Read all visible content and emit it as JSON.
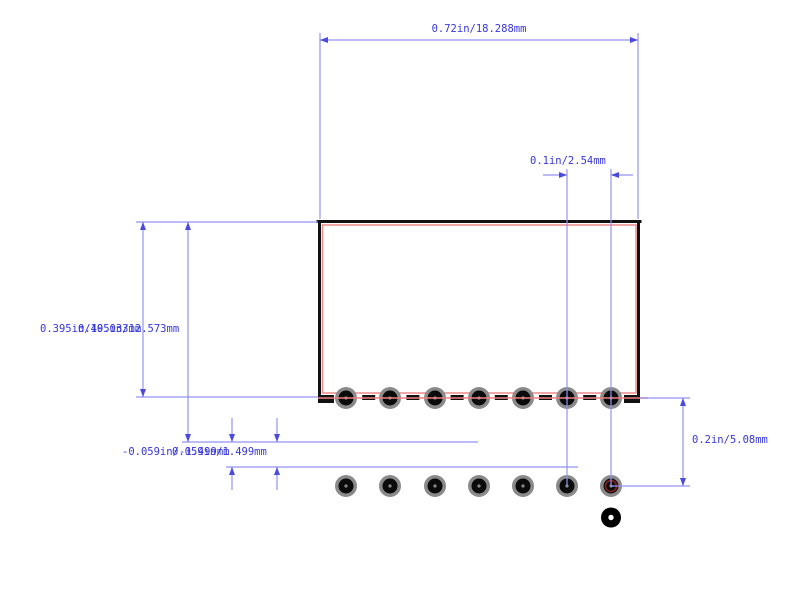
{
  "drawing": {
    "width": 800,
    "height": 590,
    "colors": {
      "background": "#ffffff",
      "dim_line": "#9292f2",
      "dim_arrow": "#4a4ade",
      "dim_text": "#3636df",
      "body_outline": "#111111",
      "silkscreen": "#ee8a8a",
      "centerline": "#f08080",
      "pad_outer": "#8a8a8a",
      "pad_inner": "#0b0b0b",
      "pad_center_dot": "#8a8a8a",
      "pin_marker_ring": "#7a2020",
      "hole_fill": "#000000",
      "hole_center": "#ffffff"
    },
    "body": {
      "x1": 318,
      "y1": 220,
      "x2": 640,
      "y2": 398,
      "edge_width": 3,
      "dashed_bottom": {
        "y": 397.5,
        "thickness": 5,
        "dash": 13,
        "gap": 31.2
      },
      "corner_feet": [
        [
          318,
          395,
          16,
          8
        ],
        [
          624,
          395,
          16,
          8
        ]
      ]
    },
    "silkscreen_rect": {
      "x1": 322.5,
      "y1": 225,
      "x2": 636,
      "y2": 393,
      "stroke_width": 1.5
    },
    "centerline": {
      "x1": 318,
      "y": 398,
      "x2": 648,
      "stroke_width": 1.6
    },
    "pads": {
      "xs": [
        346,
        390,
        435,
        479,
        523,
        567,
        611
      ],
      "row1_y": 398,
      "row2_y": 486,
      "outer_r": 11,
      "inner_r": 7.5,
      "dot_r": 1.6,
      "pin_marker": {
        "x": 611,
        "y": 486,
        "ring_r": 5.5,
        "ring_width": 1.8
      }
    },
    "mount_hole": {
      "x": 611,
      "y": 517.5,
      "outer_r": 10,
      "inner_r": 2.7
    },
    "dimension_labels": [
      {
        "id": "top-width",
        "text": "0.72in/18.288mm",
        "x": 479,
        "y": 23,
        "anchor": "middle"
      },
      {
        "id": "pitch",
        "text": "0.1in/2.54mm",
        "x": 530,
        "y": 155,
        "anchor": "start"
      },
      {
        "id": "body-height",
        "text": "0.395in/10.033mm",
        "x": 40,
        "y": 323,
        "anchor": "start"
      },
      {
        "id": "row1-offset",
        "text": "0.495in/12.573mm",
        "x": 78,
        "y": 323,
        "anchor": "start"
      },
      {
        "id": "offset-neg",
        "text": "-0.059in/-1.499mm",
        "x": 122,
        "y": 446,
        "anchor": "start"
      },
      {
        "id": "offset-pos",
        "text": "0.059in/1.499mm",
        "x": 172,
        "y": 446,
        "anchor": "start"
      },
      {
        "id": "row-spacing",
        "text": "0.2in/5.08mm",
        "x": 692,
        "y": 434,
        "anchor": "start"
      }
    ],
    "dimension_lines": [
      [
        320,
        40,
        638,
        40
      ],
      [
        320,
        33,
        320,
        219
      ],
      [
        638,
        33,
        638,
        219
      ],
      [
        543,
        175,
        567,
        175
      ],
      [
        611,
        175,
        633,
        175
      ],
      [
        567,
        169,
        567,
        486
      ],
      [
        611,
        169,
        611,
        486
      ],
      [
        136,
        222,
        318,
        222
      ],
      [
        143,
        222,
        143,
        397
      ],
      [
        188,
        222,
        188,
        442
      ],
      [
        136,
        397,
        318,
        397
      ],
      [
        182,
        442,
        478,
        442
      ],
      [
        226,
        467,
        578,
        467
      ],
      [
        232,
        418,
        232,
        442
      ],
      [
        277,
        418,
        277,
        442
      ],
      [
        232,
        467,
        232,
        490
      ],
      [
        277,
        467,
        277,
        490
      ],
      [
        611,
        486,
        690,
        486
      ],
      [
        640,
        398,
        690,
        398
      ],
      [
        683,
        398,
        683,
        486
      ]
    ],
    "arrows": [
      {
        "x": 320,
        "y": 40,
        "dir": "left"
      },
      {
        "x": 638,
        "y": 40,
        "dir": "right"
      },
      {
        "x": 567,
        "y": 175,
        "dir": "right"
      },
      {
        "x": 611,
        "y": 175,
        "dir": "left"
      },
      {
        "x": 143,
        "y": 222,
        "dir": "up"
      },
      {
        "x": 143,
        "y": 397,
        "dir": "down"
      },
      {
        "x": 188,
        "y": 222,
        "dir": "up"
      },
      {
        "x": 188,
        "y": 442,
        "dir": "down"
      },
      {
        "x": 232,
        "y": 442,
        "dir": "down"
      },
      {
        "x": 232,
        "y": 467,
        "dir": "up"
      },
      {
        "x": 277,
        "y": 442,
        "dir": "down"
      },
      {
        "x": 277,
        "y": 467,
        "dir": "up"
      },
      {
        "x": 683,
        "y": 398,
        "dir": "up"
      },
      {
        "x": 683,
        "y": 486,
        "dir": "down"
      }
    ]
  }
}
